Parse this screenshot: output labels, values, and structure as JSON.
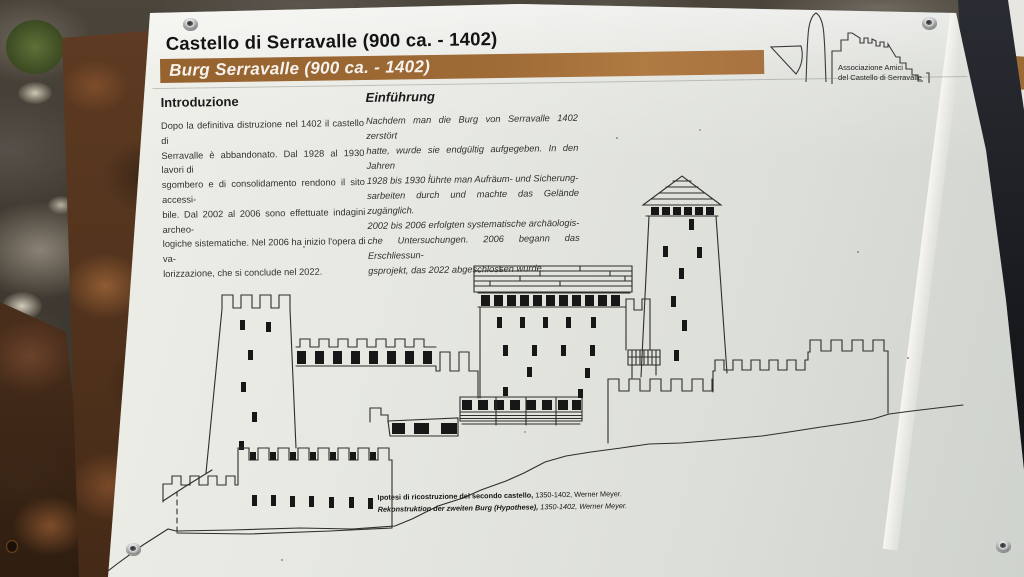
{
  "panel": {
    "title_it": "Castello di Serravalle (900 ca. - 1402)",
    "title_de": "Burg Serravalle (900 ca. - 1402)",
    "intro_it": {
      "heading": "Introduzione",
      "body_lines": [
        "Dopo la definitiva distruzione nel 1402 il castello di",
        "Serravalle è abbandonato. Dal 1928 al 1930 lavori di",
        "sgombero e di consolidamento rendono il sito accessi-",
        "bile. Dal 2002 al 2006 sono effettuate indagini archeo-",
        "logiche sistematiche. Nel 2006 ha inizio l'opera di va-",
        "lorizzazione, che si conclude nel 2022."
      ]
    },
    "intro_de": {
      "heading": "Einführung",
      "body_lines": [
        "Nachdem man die Burg von Serravalle 1402 zerstört",
        "hatte, wurde sie endgültig aufgegeben. In den Jahren",
        "1928 bis 1930 führte man Aufräum- und Sicherung-",
        "sarbeiten durch und machte das Gelände zugänglich.",
        "2002 bis 2006 erfolgten systematische archäologis-",
        "che Untersuchungen. 2006 begann das Erschliessun-",
        "gsprojekt, das 2022 abgeschlossen wurde."
      ]
    },
    "logo": {
      "line1": "Associazione Amici",
      "line2": "del Castello di Serravalle"
    },
    "caption": {
      "it_bold": "Ipotesi di ricostruzione del secondo castello,",
      "it_rest": " 1350-1402, Werner Meyer.",
      "de_bold": "Rekonstruktion der zweiten Burg (Hypothese),",
      "de_rest": " 1350-1402, Werner Meyer."
    },
    "colors": {
      "band_brown": "#9e6a35",
      "panel_white": "#e7e8e2",
      "ink": "#1c1c1c",
      "rust": "#5e3b22"
    }
  }
}
